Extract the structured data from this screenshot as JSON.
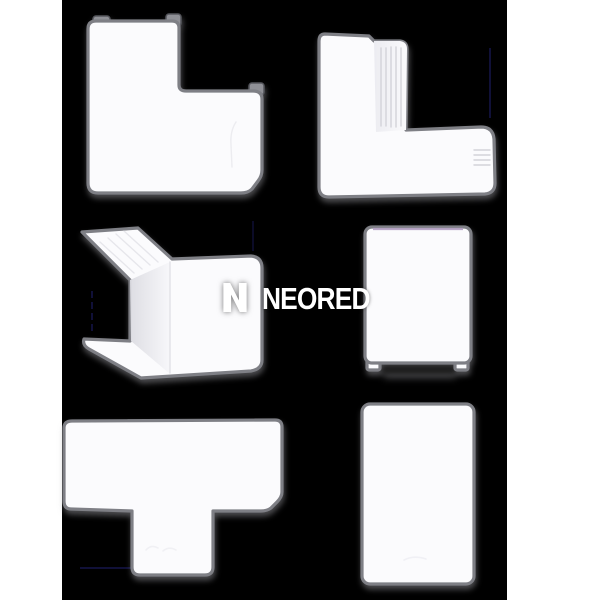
{
  "meta": {
    "type": "product-photo",
    "subject": "six white PVC cable-trunking accessory fittings on black background with white side matte strips"
  },
  "canvas": {
    "matte_color": "#ffffff",
    "photo_background": "#000000",
    "photo_left_px": 62,
    "photo_width_px": 445
  },
  "watermark": {
    "text": "NEORED",
    "color": "#ffffff",
    "logo_icon": "neored-n-logo"
  },
  "products": {
    "top_left": "flat-angle-cover-left",
    "top_right": "flat-angle-cover-right",
    "middle_left": "external-corner-3d",
    "middle_right": "small-end-cap",
    "bottom_left": "tee-cover",
    "bottom_right": "blank-cover-plate"
  },
  "colors": {
    "plastic": "#fbfbfd",
    "outline": "#7e7f85",
    "corrugation": "#d3d3d9",
    "top_accent_line": "#b29fc2",
    "floor_shadow": "#1e1e1e",
    "artifact_navy": "#16164a"
  }
}
